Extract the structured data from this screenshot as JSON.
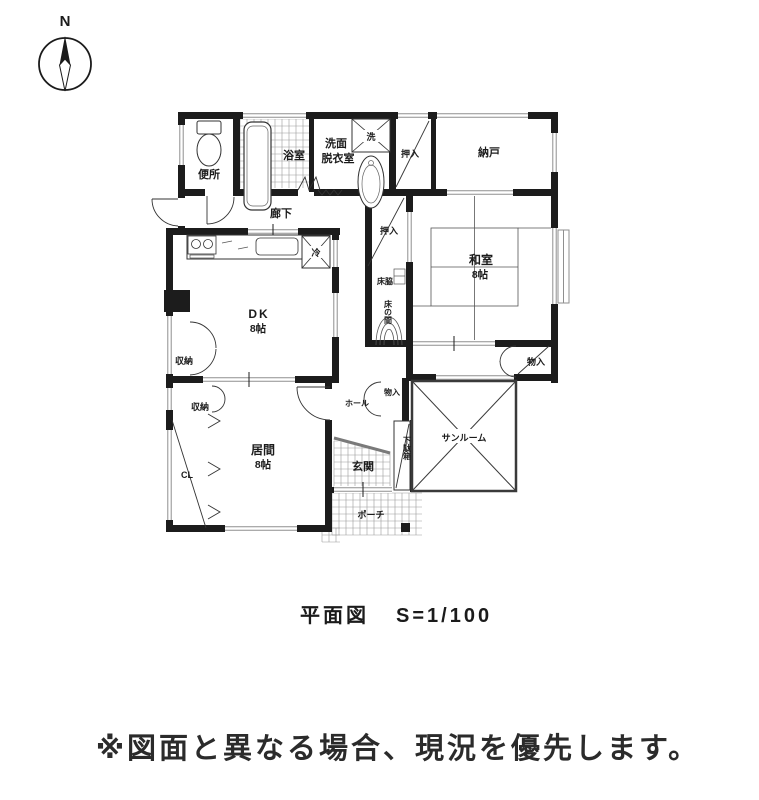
{
  "compass": {
    "north_label": "N"
  },
  "floor_plan": {
    "rooms": {
      "toilet": "便所",
      "bath": "浴室",
      "washroom_line1": "洗面",
      "washroom_line2": "脱衣室",
      "washer": "洗",
      "closet_north": "押入",
      "storeroom": "納戸",
      "corridor": "廊下",
      "fridge": "冷",
      "dk": "DK",
      "dk_size": "8帖",
      "closet_center": "押入",
      "washitsu": "和室",
      "washitsu_size": "8帖",
      "tokowaki": "床脇",
      "tokonoma": "床の間",
      "storage_east": "物入",
      "storage_dk": "収納",
      "storage_living": "収納",
      "living": "居間",
      "living_size": "8帖",
      "cl": "CL",
      "hall": "ホール",
      "storage_hall": "物入",
      "shoe_cabinet": "下駄箱",
      "entrance": "玄関",
      "sunroom": "サンルーム",
      "porch": "ポーチ"
    }
  },
  "caption": {
    "title": "平面図",
    "scale": "S=1/100"
  },
  "disclaimer": "※図面と異なる場合、現況を優先します。"
}
